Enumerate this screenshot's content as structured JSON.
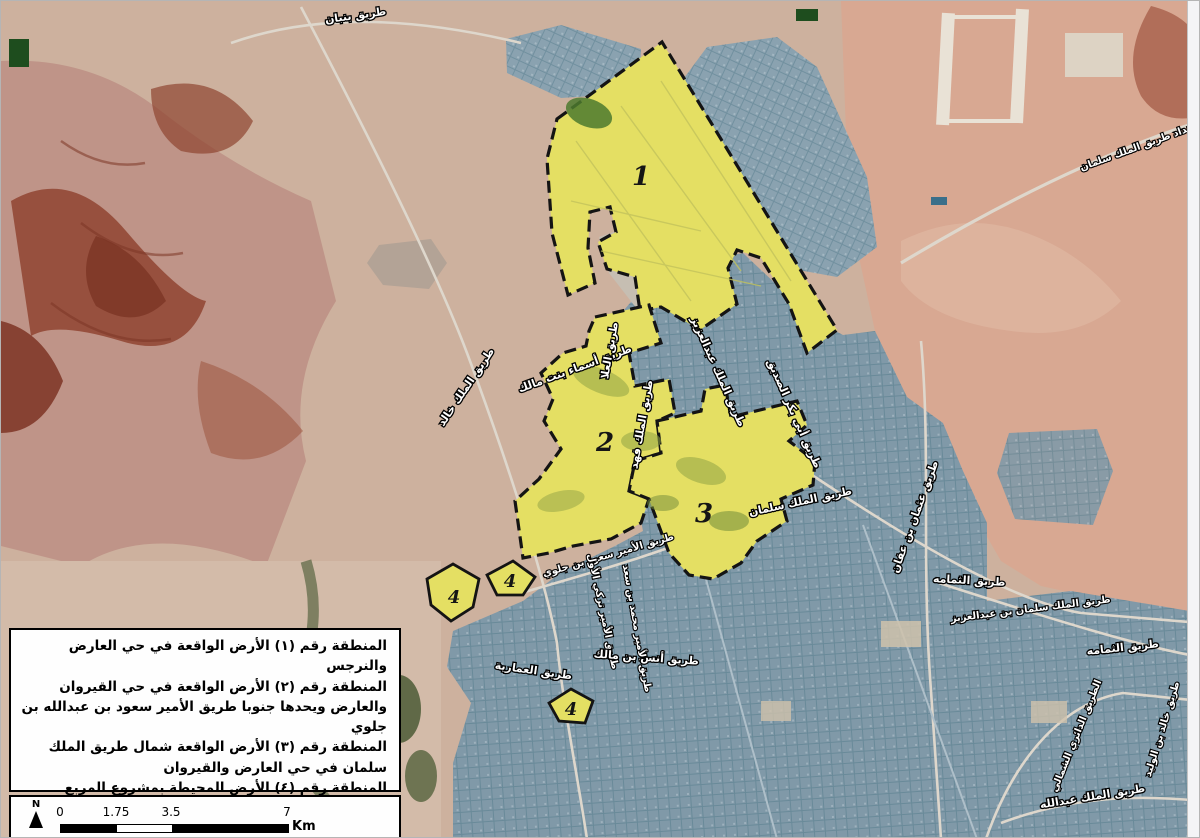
{
  "map": {
    "title": "satellite-map-of-north-riyadh-land-zones",
    "zones": [
      {
        "label": "1"
      },
      {
        "label": "2"
      },
      {
        "label": "3"
      },
      {
        "label": "4"
      },
      {
        "label": "4"
      },
      {
        "label": "4"
      }
    ],
    "road_labels": [
      {
        "text": "طريق بنبان"
      },
      {
        "text": "امتداد طريق الملك سلمان"
      },
      {
        "text": "طريق الملك خالد"
      },
      {
        "text": "طريق أسماء بنت مالك"
      },
      {
        "text": "طريق العلا"
      },
      {
        "text": "طريق الملك فهد"
      },
      {
        "text": "طريق الملك عبدالعزيز"
      },
      {
        "text": "طريق أبي بكر الصديق"
      },
      {
        "text": "طريق الملك سلمان"
      },
      {
        "text": "طريق عثمان بن عفان"
      },
      {
        "text": "طريق الثمامه"
      },
      {
        "text": "طريق الثمامه"
      },
      {
        "text": "طريق الملك سلمان بن عبدالعزيز"
      },
      {
        "text": "طريق الأمير سعود بن جلوي"
      },
      {
        "text": "طريق الأمير تركي الأول"
      },
      {
        "text": "طريق الأمير محمد بن سعد"
      },
      {
        "text": "طريق أنس بن مالك"
      },
      {
        "text": "طريق العمارية"
      },
      {
        "text": "الطريق الدائري الشمالي"
      },
      {
        "text": "طريق الملك عبدالله"
      },
      {
        "text": "طريق خالد بن الوليد"
      }
    ]
  },
  "legend": {
    "items": [
      {
        "text": "المنطقة رقم (١) الأرض الواقعة في حي العارض والنرجس"
      },
      {
        "text": "المنطقة رقم (٢) الأرض الواقعة في حي القيروان والعارض ويحدها جنوبا طريق الأمير سعود بن عبدالله بن جلوي"
      },
      {
        "text": "المنطقة رقم (٣) الأرض الواقعة شمال طريق الملك سلمان في حي العارض والقيروان"
      },
      {
        "text": "المنطقة رقم (٤) الأرض المحيطة بمشروع المربع الجديد"
      }
    ]
  },
  "scale_bar": {
    "ticks": [
      "0",
      "1.75",
      "3.5",
      "7"
    ],
    "unit": "Km",
    "north_label": "N"
  },
  "colors": {
    "zone_fill": "#e4df63",
    "zone_border": "#141414",
    "urban_blue": "#8aa2b0",
    "desert_west": "#bf9488",
    "desert_east": "#d8a892",
    "rock_red": "#8f4431",
    "label_text": "#ffffff",
    "label_outline": "#000000"
  }
}
